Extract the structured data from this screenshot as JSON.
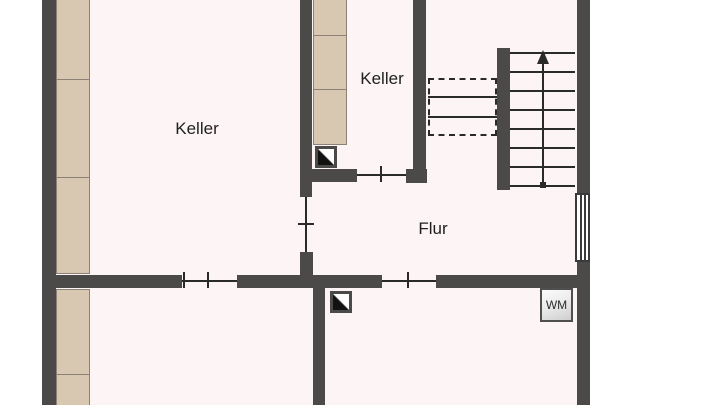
{
  "rooms": {
    "keller_left": {
      "label": "Keller"
    },
    "keller_middle": {
      "label": "Keller"
    },
    "flur": {
      "label": "Flur"
    }
  },
  "appliances": {
    "washing_machine": {
      "label": "WM"
    }
  },
  "stairs": {
    "tread_count": 8,
    "tread_top_y": 52,
    "tread_spacing": 19,
    "direction": "up"
  },
  "colors": {
    "wall": "#4b4a48",
    "room_fill": "#fdf4f5",
    "outside": "#ffffff",
    "cabinet_fill": "#d8c8b2",
    "cabinet_border": "#8b8176",
    "line": "#2a2a2a",
    "text": "#1f1f1f"
  }
}
